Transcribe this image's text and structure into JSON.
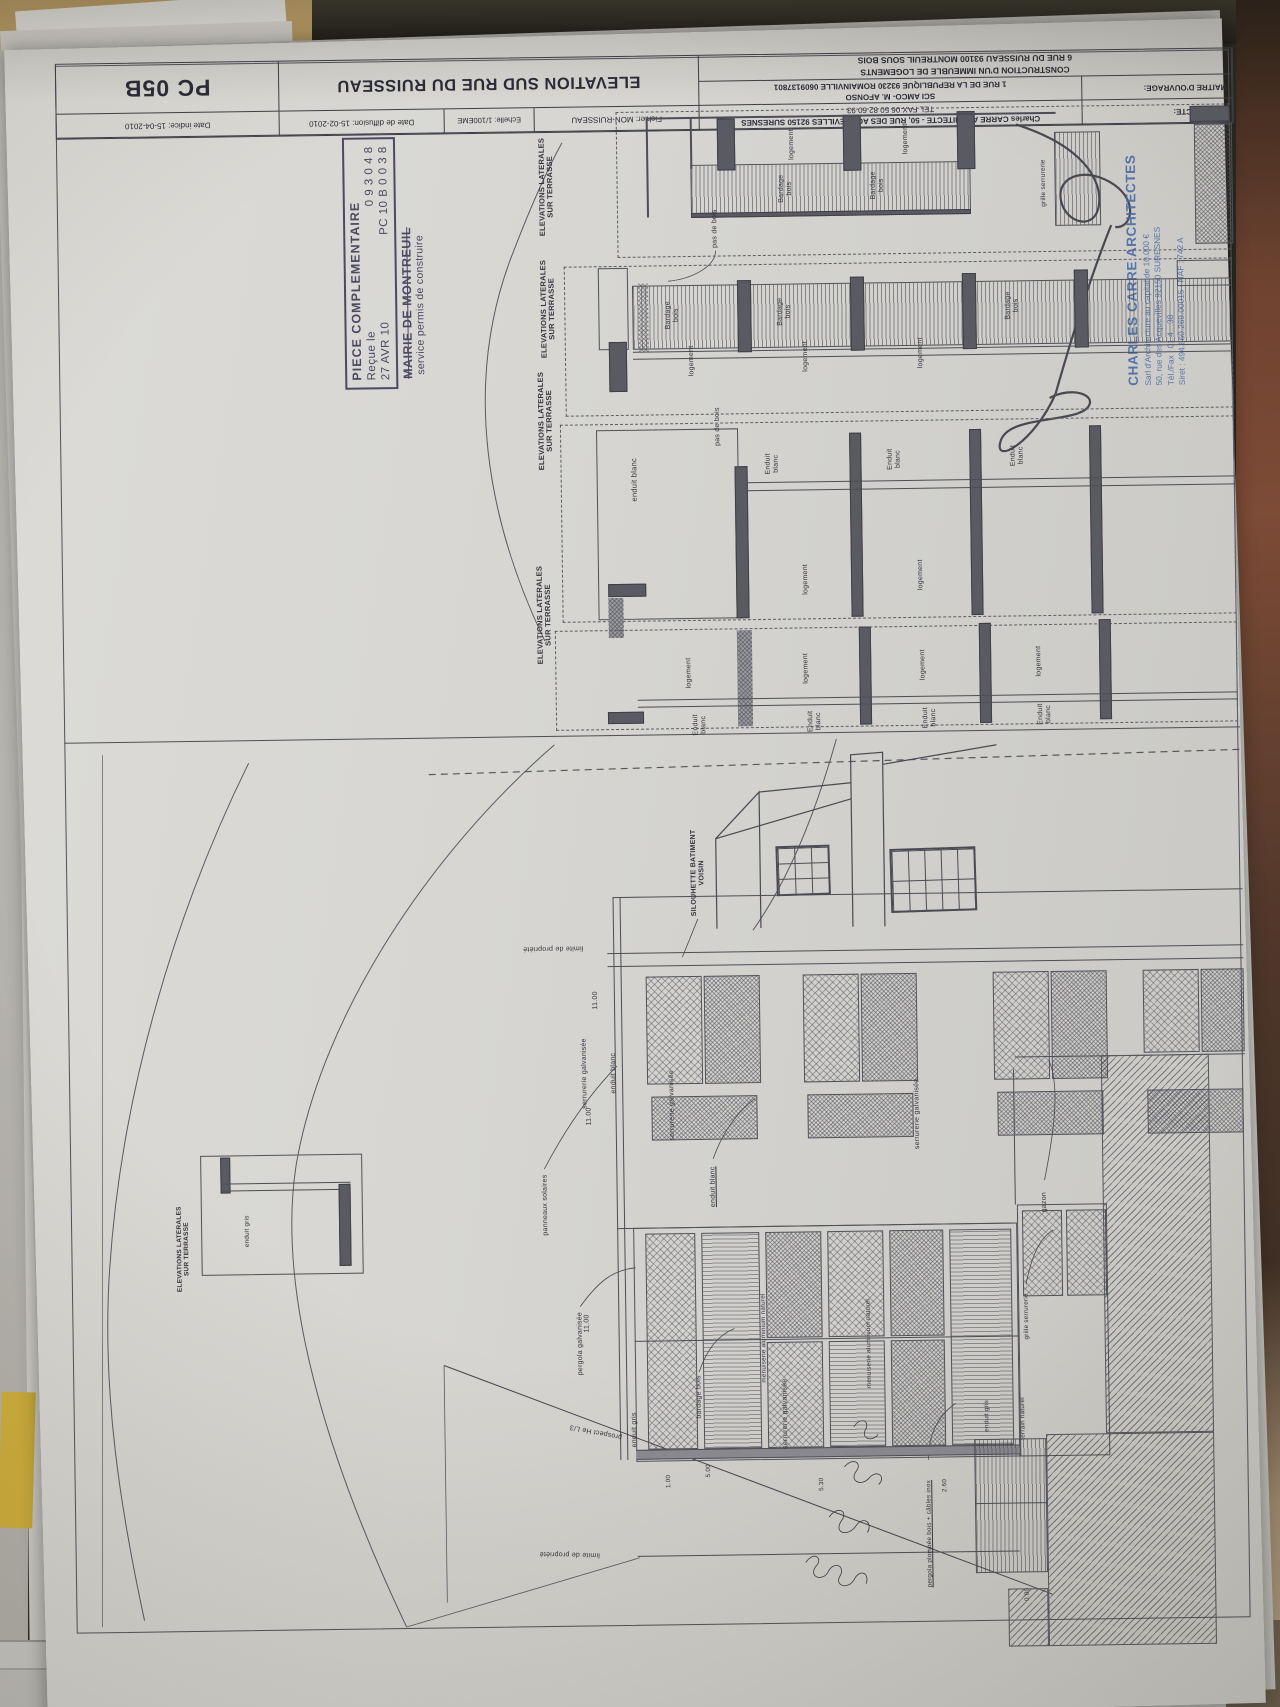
{
  "title_block": {
    "architecte_label": "ARCHITECTE:",
    "architecte_line1": "Charles CARRE ARCHITECTE - 50, RUE DES ACQUEVILLES 92150 SURESNES",
    "architecte_line2": "TEL FAX 06 50 82 60 93",
    "moa_label": "MAITRE D'OUVRAGE:",
    "moa_line1": "SCI AMCO- M. AFONSO",
    "moa_line2": "1 RUE DE LA REPUBLIQUE 93230 ROMAINVILLE 0609137801",
    "project_line1": "CONSTRUCTION D'UN IMMEUBLE DE LOGEMENTS",
    "project_line2": "6 RUE DU RUISSEAU 93100 MONTREUIL SOUS BOIS",
    "fichier": "Fichier:  MON-RUISSEAU",
    "echelle": "Echelle: 1/100EME",
    "date_diffusion": "Date de diffusion:  15-02-2010",
    "date_indice": "Date indice:  15-04-2010",
    "title": "ELEVATION SUD RUE DU RUISSEAU",
    "sheet_code": "PC 05B"
  },
  "stamp": {
    "line1": "PIECE COMPLEMENTAIRE",
    "line2_left": "Reçue le",
    "line2_right": "0 9 3 0 4 8",
    "line3_left": "27 AVR 10",
    "line3_right": "PC 10 B 0 0 3 8",
    "line4": "MAIRIE DE MONTREUIL",
    "line5": "service permis de construire"
  },
  "architect_stamp": {
    "name": "CHARLES CARRE ARCHITECTES",
    "line2": "Sarl d'Architecture au capital de 10.000 €",
    "line3": "50, rue des Acquevilles 92150 SURESNES",
    "line4": "Tél./Fax : 01.4…38",
    "line5": "Siret : 494.660.269.00015 - NAF : 742 A"
  },
  "colors": {
    "paper": "#d7d6d2",
    "drawing_ink": "#4d4d57",
    "stamp_ink": "#4c4962",
    "architect_stamp_blue": "#4a6ba6",
    "backdrop_tan": "#c1a26a",
    "backdrop_brown": "#6f4330",
    "yellow_sheet": "#d2b13c"
  },
  "annotations": [
    {
      "t": "ELEVATIONS LATERALES\nSUR TERRASSE",
      "x": 556,
      "y": 186,
      "s": 7.5,
      "b": 1
    },
    {
      "t": "ELEVATIONS LATERALES\nSUR TERRASSE",
      "x": 556,
      "y": 308,
      "s": 7.5,
      "b": 1
    },
    {
      "t": "ELEVATIONS LATERALES\nSUR TERRASSE",
      "x": 552,
      "y": 420,
      "s": 7.5,
      "b": 1
    },
    {
      "t": "ELEVATIONS LATERALES\nSUR TERRASSE",
      "x": 548,
      "y": 614,
      "s": 7.5,
      "b": 1
    },
    {
      "t": "ELEVATIONS LATERALES\nSUR TERRASSE",
      "x": 178,
      "y": 1243,
      "s": 6.5,
      "b": 1
    },
    {
      "t": "logement",
      "x": 802,
      "y": 147
    },
    {
      "t": "logement",
      "x": 916,
      "y": 143
    },
    {
      "t": "Bardage\nbois",
      "x": 795,
      "y": 191
    },
    {
      "t": "Bardage\nbois",
      "x": 887,
      "y": 189
    },
    {
      "t": "pas de bois",
      "x": 724,
      "y": 230
    },
    {
      "t": "grille serrurerie",
      "x": 1053,
      "y": 189,
      "s": 6.5
    },
    {
      "t": "Bardage\nbois",
      "x": 680,
      "y": 316
    },
    {
      "t": "Bardage\nbois",
      "x": 792,
      "y": 314
    },
    {
      "t": "Bardage\nbois",
      "x": 1020,
      "y": 311
    },
    {
      "t": "logement",
      "x": 699,
      "y": 362
    },
    {
      "t": "logement",
      "x": 813,
      "y": 359
    },
    {
      "t": "logement",
      "x": 928,
      "y": 357
    },
    {
      "t": "pas de bois",
      "x": 724,
      "y": 428
    },
    {
      "t": "enduit blanc",
      "x": 640,
      "y": 480,
      "s": 7.5
    },
    {
      "t": "Enduit\nblanc",
      "x": 778,
      "y": 466
    },
    {
      "t": "Enduit\nblanc",
      "x": 900,
      "y": 463
    },
    {
      "t": "Enduit\nblanc",
      "x": 1023,
      "y": 461
    },
    {
      "t": "logement",
      "x": 810,
      "y": 582
    },
    {
      "t": "logement",
      "x": 925,
      "y": 579
    },
    {
      "t": "logement",
      "x": 692,
      "y": 674
    },
    {
      "t": "logement",
      "x": 809,
      "y": 671
    },
    {
      "t": "logement",
      "x": 926,
      "y": 669
    },
    {
      "t": "logement",
      "x": 1042,
      "y": 667
    },
    {
      "t": "Enduit\nblanc",
      "x": 702,
      "y": 726
    },
    {
      "t": "Enduit\nblanc",
      "x": 817,
      "y": 724
    },
    {
      "t": "Enduit\nblanc",
      "x": 932,
      "y": 722
    },
    {
      "t": "Enduit\nblanc",
      "x": 1047,
      "y": 720
    },
    {
      "t": "SILOUHETTE BATIMENT\nVOISIN",
      "x": 698,
      "y": 874,
      "s": 7,
      "b": 1
    },
    {
      "t": "limite de propriété",
      "x": 552,
      "y": 947,
      "r": 180
    },
    {
      "t": "limite de propriété",
      "x": 560,
      "y": 1553,
      "r": 182
    },
    {
      "t": "prospect He L/3",
      "x": 588,
      "y": 1431,
      "r": 192
    },
    {
      "t": "11.00",
      "x": 594,
      "y": 1000
    },
    {
      "t": "11.00",
      "x": 586,
      "y": 1116
    },
    {
      "t": "11.00",
      "x": 581,
      "y": 1323
    },
    {
      "t": "serrurerie galvanisée",
      "x": 582,
      "y": 1073
    },
    {
      "t": "serrurerie galvanisée",
      "x": 669,
      "y": 1106
    },
    {
      "t": "serrurerie galvanisée",
      "x": 914,
      "y": 1118
    },
    {
      "t": "serrurerie galvanisée",
      "x": 778,
      "y": 1416
    },
    {
      "t": "enduit blanc",
      "x": 611,
      "y": 1073
    },
    {
      "t": "enduit blanc",
      "x": 709,
      "y": 1188,
      "u": 1
    },
    {
      "t": "panneaux solaires",
      "x": 541,
      "y": 1204
    },
    {
      "t": "pergola galvanisée",
      "x": 574,
      "y": 1343
    },
    {
      "t": "enduit gris",
      "x": 627,
      "y": 1430
    },
    {
      "t": "bardage bois",
      "x": 692,
      "y": 1398
    },
    {
      "t": "menuiserie aluminium naturel",
      "x": 757,
      "y": 1340,
      "s": 6.3
    },
    {
      "t": "menuiserie aluminium naturel",
      "x": 862,
      "y": 1347,
      "s": 6.3
    },
    {
      "t": "gazon",
      "x": 1040,
      "y": 1208
    },
    {
      "t": "grille serrurerie",
      "x": 1020,
      "y": 1322,
      "s": 6.3
    },
    {
      "t": "enduit gris",
      "x": 979,
      "y": 1421,
      "s": 6.3
    },
    {
      "t": "terrain naturel",
      "x": 1015,
      "y": 1424,
      "s": 6.3
    },
    {
      "t": "pergola plombée bois + câbles inox",
      "x": 920,
      "y": 1538,
      "s": 6.3,
      "u": 1
    },
    {
      "t": "1.00",
      "x": 660,
      "y": 1482,
      "s": 6.3
    },
    {
      "t": "5.00",
      "x": 700,
      "y": 1472,
      "s": 6.3
    },
    {
      "t": "5.30",
      "x": 813,
      "y": 1487,
      "s": 6.3
    },
    {
      "t": "2.60",
      "x": 936,
      "y": 1490,
      "s": 6.3
    },
    {
      "t": "0.00",
      "x": 1017,
      "y": 1600,
      "s": 6.3
    },
    {
      "t": "enduit gris",
      "x": 242,
      "y": 1226,
      "s": 6.3
    }
  ]
}
